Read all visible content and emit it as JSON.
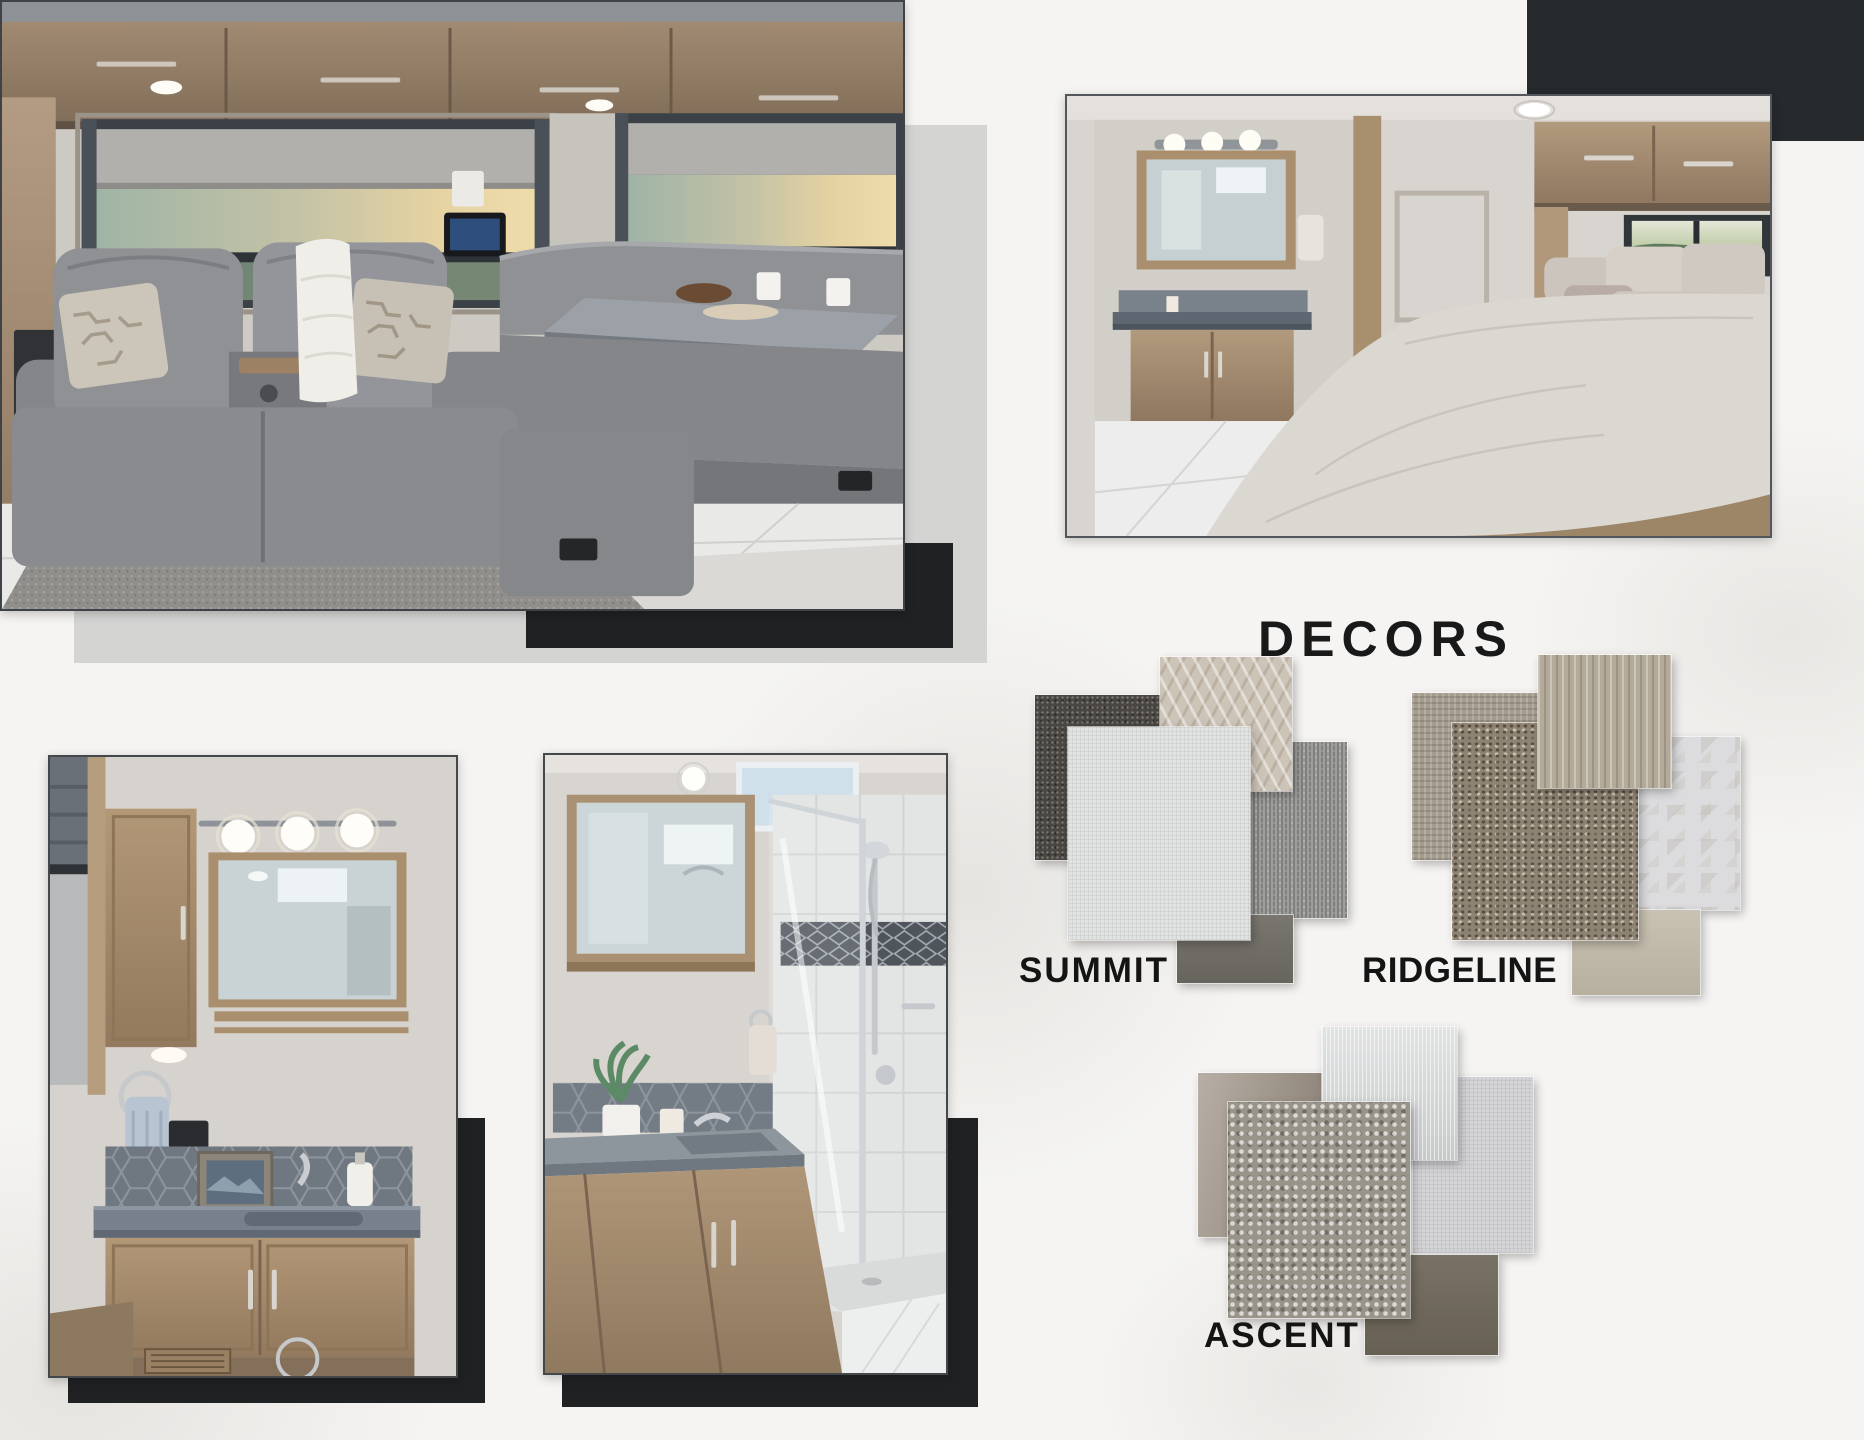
{
  "page": {
    "background_color": "#f5f4f2",
    "accent_colors": {
      "light_gray_panel": "#d4d4d3",
      "black_panel": "#1f2123",
      "charcoal_panel": "#272a2d"
    }
  },
  "photos": [
    {
      "name": "living-room",
      "description": "RV living room with gray leather theater seating, patterned pillows and dinette by panoramic sunset windows"
    },
    {
      "name": "bedroom",
      "description": "RV bedroom with king bed, overhead cabinets, rear window and adjoining bathroom vanity"
    },
    {
      "name": "vanity-bathroom",
      "description": "RV bathroom vanity with lighted mirror, hex tile backsplash, sink and wood cabinetry"
    },
    {
      "name": "shower-bathroom",
      "description": "RV bathroom with vanity sink, plant and glass-enclosed tile shower"
    }
  ],
  "decors": {
    "title": "DECORS",
    "options": [
      {
        "name": "SUMMIT",
        "swatches": [
          {
            "name": "charcoal-carpet",
            "color": "#4a4742"
          },
          {
            "name": "geometric-taupe-fabric",
            "color": "#cdc4b8"
          },
          {
            "name": "heather-gray-fabric",
            "color": "#8e8e8c"
          },
          {
            "name": "ivory-linen-fabric",
            "color": "#e0e3e2"
          },
          {
            "name": "slate-gray-solid",
            "color": "#6f6c64"
          }
        ]
      },
      {
        "name": "RIDGELINE",
        "swatches": [
          {
            "name": "taupe-weave-fabric",
            "color": "#a49c8f"
          },
          {
            "name": "striped-sand-fabric",
            "color": "#b4aa9a"
          },
          {
            "name": "brown-tweed-fabric",
            "color": "#8e8373"
          },
          {
            "name": "white-geometric-fabric",
            "color": "#dcdbde"
          },
          {
            "name": "khaki-solid",
            "color": "#c5bdac"
          }
        ]
      },
      {
        "name": "ASCENT",
        "swatches": [
          {
            "name": "mocha-shimmer-fabric",
            "color": "#a3988c"
          },
          {
            "name": "silver-texture-fabric",
            "color": "#d8dadb"
          },
          {
            "name": "pebbled-silver-fabric",
            "color": "#99948a"
          },
          {
            "name": "pale-gray-linen-fabric",
            "color": "#d4d3d6"
          },
          {
            "name": "dark-taupe-solid",
            "color": "#6e6759"
          }
        ]
      }
    ]
  }
}
